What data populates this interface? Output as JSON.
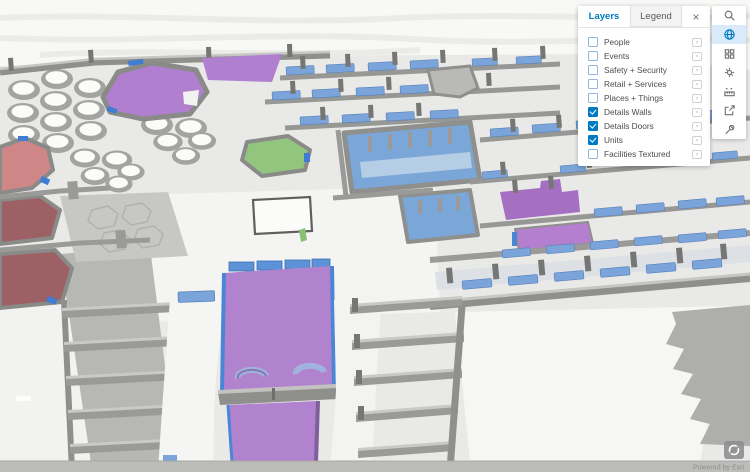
{
  "panel": {
    "tabs": [
      {
        "label": "Layers",
        "active": true
      },
      {
        "label": "Legend",
        "active": false
      }
    ],
    "close_label": "×",
    "layers": [
      {
        "label": "People",
        "checked": false
      },
      {
        "label": "Events",
        "checked": false
      },
      {
        "label": "Safety + Security",
        "checked": false
      },
      {
        "label": "Retail + Services",
        "checked": false
      },
      {
        "label": "Places + Things",
        "checked": false
      },
      {
        "label": "Details Walls",
        "checked": true
      },
      {
        "label": "Details Doors",
        "checked": true
      },
      {
        "label": "Units",
        "checked": true
      },
      {
        "label": "Facilities Textured",
        "checked": false
      }
    ]
  },
  "toolbar": {
    "active_index": 1,
    "items": [
      "search",
      "globe",
      "basemap-grid",
      "settings-gear",
      "measure",
      "share",
      "tools-wrench"
    ]
  },
  "map": {
    "type": "3d-indoor-scene",
    "attribution": "Powered by Esri",
    "colors": {
      "unit_purple": "#b183ce",
      "unit_green": "#92c57e",
      "unit_salmon": "#ce8686",
      "unit_maroon": "#9d6165",
      "glass_blue": "#7aa4da",
      "door_blue": "#3f7dd2",
      "restroom_blue": "#7aa6d8",
      "wall_gray": "#8f8f8d",
      "floor_light": "#eaeae8",
      "floor_white": "#f5f5f3",
      "accent_blue": "#0079c1"
    }
  }
}
